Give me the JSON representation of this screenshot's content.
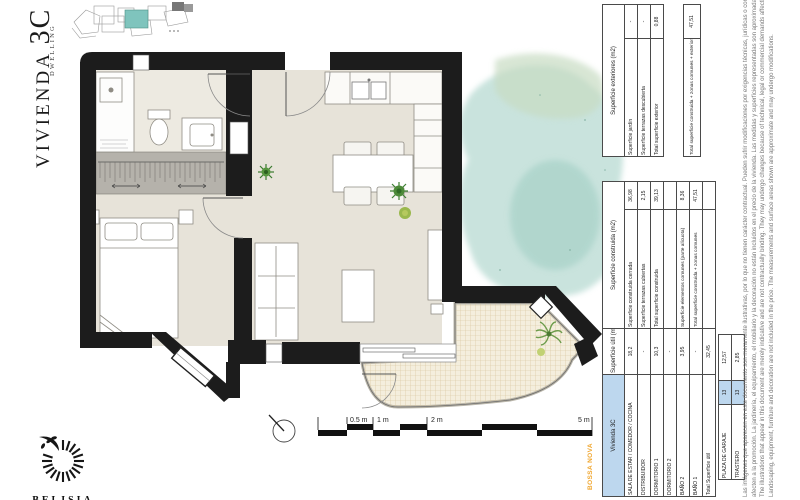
{
  "title": {
    "main": "VIVIENDA",
    "number": "3C",
    "sub": "DWELLING"
  },
  "brand": {
    "name": "BELISIA"
  },
  "project_label": "BOSSA NOVA",
  "scale_bar": {
    "labels": [
      "0.5 m",
      "1 m",
      "2 m",
      "5 m"
    ]
  },
  "colors": {
    "wall": "#1c1c1c",
    "floor": "#e7e3d9",
    "table_header_blue": "#bdd7ee",
    "keyplan_highlight_teal": "#7fc4bd",
    "brand_orange": "#f0a62e",
    "watercolor_teal": "#b7dad2"
  },
  "tables": {
    "main": {
      "header": {
        "name": "Vivienda 3C",
        "util": "Superficie útil (m2)",
        "cons": "Superficie construida (m2)"
      },
      "rows": [
        {
          "name": "SALA DE ESTAR / COMEDOR / COCINA",
          "util": "18,2",
          "cons_label": "Superficie construida cerrada",
          "cons_value": "36,98"
        },
        {
          "name": "DISTRIBUIDOR",
          "util": "-",
          "cons_label": "Superficie terrazas cubiertas",
          "cons_value": "2,15"
        },
        {
          "name": "DORMITORIO 1",
          "util": "10,3",
          "cons_label": "Total superficie construida",
          "cons_value": "39,13"
        },
        {
          "name": "DORMITORIO 2",
          "util": "-",
          "cons_label": "",
          "cons_value": ""
        },
        {
          "name": "BAÑO 2",
          "util": "3,95",
          "cons_label": "Superficie elementos comunes (parte alícuota)",
          "cons_value": "8,36"
        },
        {
          "name": "BAÑO 1",
          "util": "-",
          "cons_label": "Total superficie construida + zonas comunes",
          "cons_value": "47,51"
        },
        {
          "name": "Total Superficie útil",
          "util": "32,45",
          "cons_label": "",
          "cons_value": ""
        }
      ]
    },
    "garage": {
      "rows": [
        {
          "label": "PLAZA DE GARAJE",
          "num": "13",
          "value": "12,57"
        },
        {
          "label": "TRASTERO",
          "num": "13",
          "value": "2,85"
        }
      ]
    },
    "exteriores": {
      "header": "Superficie exteriores (m2)",
      "rows": [
        {
          "label": "Superficie jardín",
          "value": "-"
        },
        {
          "label": "Superficie terrazas descubierta",
          "value": "-"
        },
        {
          "label": "Total superficie exterior",
          "value": "0,88"
        }
      ],
      "total": {
        "label": "Total superficie construida + zonas comunes + exterior",
        "value": "47,51"
      }
    }
  },
  "disclaimer": {
    "l1": "Las imágenes que aparecen en este documento son meramente ilustrativas, por lo que no tienen carácter contractual. Pueden sufrir modificaciones por exigencias técnicas, jurídicas o comerciales que",
    "l2": "afecten a la promoción. La jardinería, el equipamiento, el mobiliario y la decoración no están incluidos en el precio de la vivienda. Las medidas y superficies representadas son aproximadas y pueden sufrir variaciones.",
    "l3": "The illustrations that appear in this document are merely indicative and are not contractually binding. They may undergo changes because of technical, legal or commercial demands affecting the development.",
    "l4": "Landscaping, equipment, furniture and decoration are not included in the price. The measurements and surface areas shown are approximate and may undergo modifications."
  }
}
